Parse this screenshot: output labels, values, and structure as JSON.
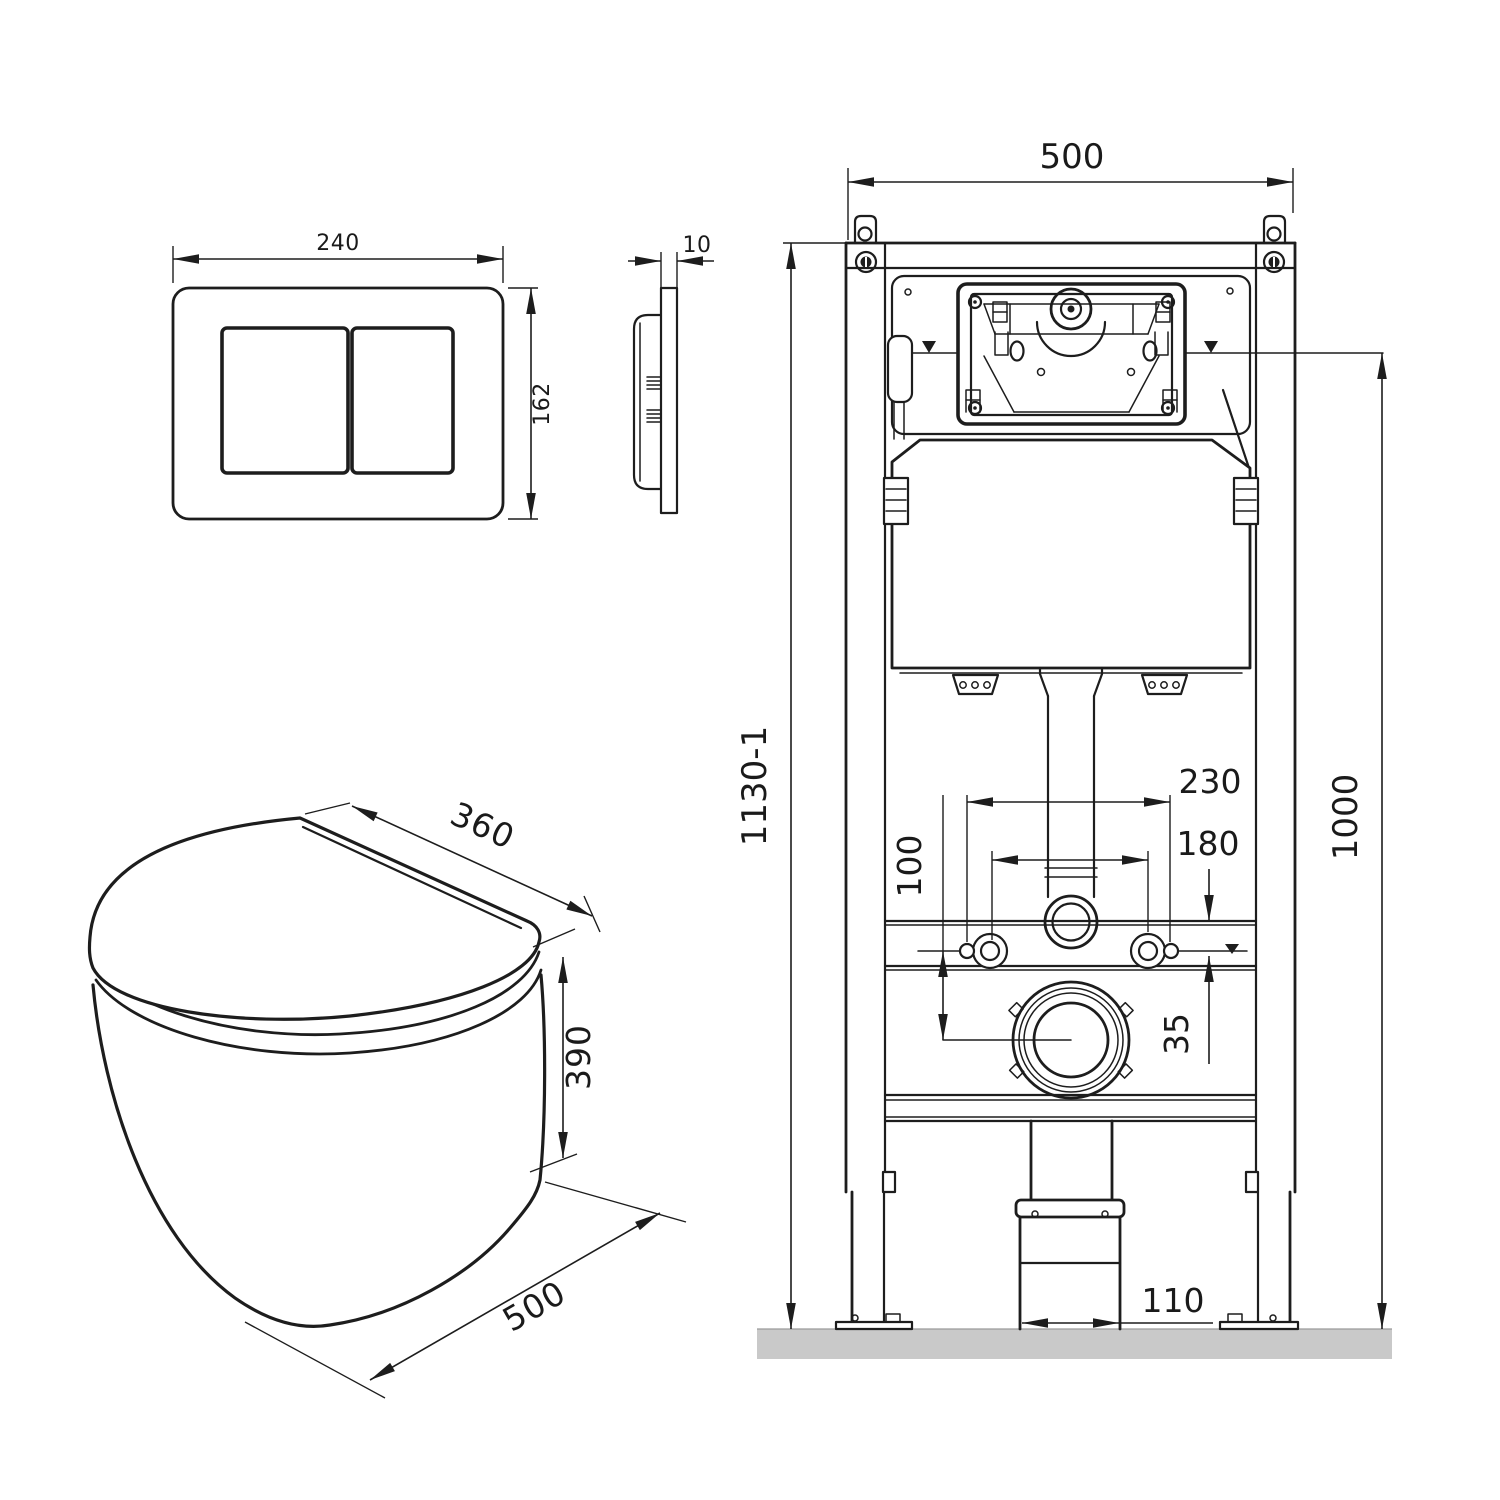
{
  "drawing": {
    "type": "technical-installation-diagram",
    "subject": "wall-hung toilet with concealed cistern frame and flush plate",
    "units": "mm"
  },
  "flush_plate_front": {
    "width_label": "240",
    "height_label": "162"
  },
  "flush_plate_side": {
    "thickness_label": "10"
  },
  "toilet_bowl": {
    "seat_width_label": "360",
    "height_label": "390",
    "depth_label": "500"
  },
  "installation_frame": {
    "width_label": "500",
    "total_height_label": "1130-1",
    "flush_level_height_label": "1000",
    "outer_fixing_span_label": "230",
    "inner_fixing_span_label": "180",
    "drain_drop_label": "100",
    "ledge_offset_label": "35",
    "drain_pipe_width_label": "110"
  },
  "colors": {
    "line": "#1d1d1d",
    "floor": "#c9c9c9",
    "background": "#ffffff"
  }
}
